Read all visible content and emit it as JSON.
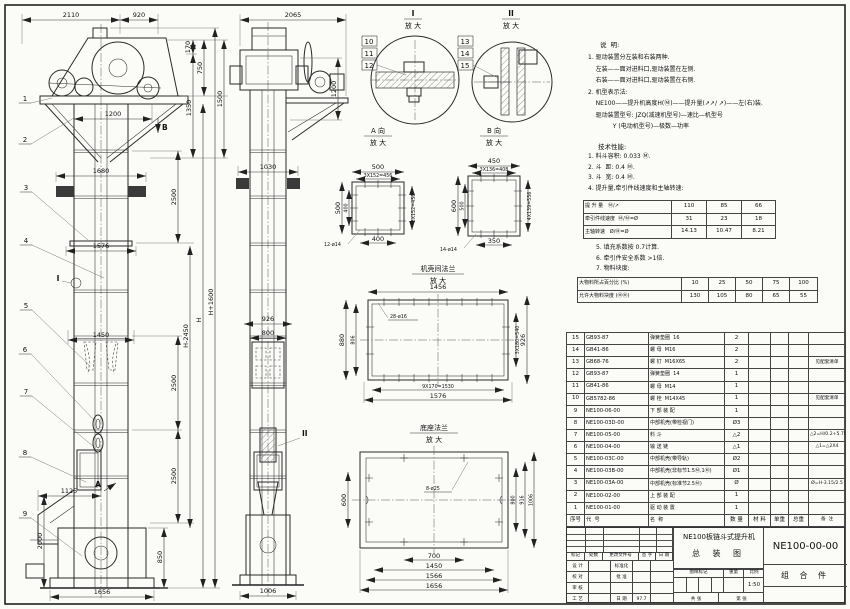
{
  "notes": {
    "title": "说  明:",
    "lines": [
      "1. 驱动装置分左装和右装两种.",
      "    左装——面对进料口,驱动装置在左侧.",
      "    右装——面对进料口,驱动装置在右侧.",
      "2. 机型表示法:",
      "    NE100——提升机高度H(Ⓜ)——提升量(↗↗/ ↗)——左(右)装.",
      "    驱动装置型号: JZQ(减速机型号)—速比—机型号",
      "             Y (电动机型号)—极数—功率"
    ]
  },
  "tech": {
    "title": "技术性能:",
    "lines": [
      "1. 料斗容积: 0.033 Ⓜ.",
      "2. 斗  距: 0.4 Ⓜ.",
      "3. 斗  宽: 0.4 Ⓜ.",
      "4. 提升量,牵引件线速度和主轴转速:"
    ],
    "lines2": [
      "5. 填充系数按 0.7计算.",
      "6. 牵引件安全系数 >1倍.",
      "7. 物料块度:"
    ]
  },
  "speed_table": {
    "rows": [
      [
        "提 升 量   Ⓜ/↗",
        "110",
        "85",
        "66"
      ],
      [
        "牵引件线速度  Ⓜ/Ⓜ=Ø",
        "31",
        "23",
        "18"
      ],
      [
        "主轴转速   Ø/Ⓜ=Ø",
        "14.13",
        "10.47",
        "8.21"
      ]
    ]
  },
  "lump_table": {
    "rows": [
      [
        "大物料所占百分比 (%)",
        "10",
        "25",
        "50",
        "75",
        "100"
      ],
      [
        "允许大物料块度 (ⓂⓂ)",
        "130",
        "105",
        "80",
        "65",
        "55"
      ]
    ]
  },
  "bom": {
    "rows": [
      {
        "seq": "15",
        "code": "GB93-87",
        "name": "弹簧垫圈  16",
        "qty": "2",
        "material": "",
        "uw": "",
        "tw": "",
        "remark": ""
      },
      {
        "seq": "14",
        "code": "GB41-86",
        "name": "螺 母  M16",
        "qty": "2",
        "material": "",
        "uw": "",
        "tw": "",
        "remark": ""
      },
      {
        "seq": "13",
        "code": "GB68-76",
        "name": "螺 钉  M16X65",
        "qty": "2",
        "material": "",
        "uw": "",
        "tw": "",
        "remark": "见配套清单"
      },
      {
        "seq": "12",
        "code": "GB93-87",
        "name": "弹簧垫圈  14",
        "qty": "1",
        "material": "",
        "uw": "",
        "tw": "",
        "remark": ""
      },
      {
        "seq": "11",
        "code": "GB41-86",
        "name": "螺 母  M14",
        "qty": "1",
        "material": "",
        "uw": "",
        "tw": "",
        "remark": ""
      },
      {
        "seq": "10",
        "code": "GB5782-86",
        "name": "螺 栓  M14X45",
        "qty": "1",
        "material": "",
        "uw": "",
        "tw": "",
        "remark": "见配套清单"
      },
      {
        "seq": "9",
        "code": "NE100-06-00",
        "name": "下 部 装 配",
        "qty": "1",
        "material": "",
        "uw": "",
        "tw": "",
        "remark": ""
      },
      {
        "seq": "8",
        "code": "NE100-03D-00",
        "name": "中部机壳(带检视门)",
        "qty": "Ø3",
        "material": "",
        "uw": "",
        "tw": "",
        "remark": ""
      },
      {
        "seq": "7",
        "code": "NE100-05-00",
        "name": "料 斗",
        "qty": "△2",
        "material": "",
        "uw": "",
        "tw": "",
        "remark": "△2=H/0.2+5.75"
      },
      {
        "seq": "6",
        "code": "NE100-04-00",
        "name": "输 送 链",
        "qty": "△1",
        "material": "",
        "uw": "",
        "tw": "",
        "remark": "△1=△2X4"
      },
      {
        "seq": "5",
        "code": "NE100-03C-00",
        "name": "中部机壳(带导轨)",
        "qty": "Ø2",
        "material": "",
        "uw": "",
        "tw": "",
        "remark": ""
      },
      {
        "seq": "4",
        "code": "NE100-03B-00",
        "name": "中部机壳(非标节1.5Ⓜ,1Ⓜ)",
        "qty": "Ø1",
        "material": "",
        "uw": "",
        "tw": "",
        "remark": ""
      },
      {
        "seq": "3",
        "code": "NE100-03A-00",
        "name": "中部机壳(标准节2.5Ⓜ)",
        "qty": "Ø",
        "material": "",
        "uw": "",
        "tw": "",
        "remark": "Ø=H-3.15/2.5"
      },
      {
        "seq": "2",
        "code": "NE100-02-00",
        "name": "上 部 装 配",
        "qty": "1",
        "material": "",
        "uw": "",
        "tw": "",
        "remark": ""
      },
      {
        "seq": "1",
        "code": "NE100-01-00",
        "name": "驱 动 装 置",
        "qty": "1",
        "material": "",
        "uw": "",
        "tw": "",
        "remark": ""
      }
    ],
    "footer": [
      "序号",
      "代  号",
      "名  称",
      "数 量",
      "材 料",
      "单重",
      "总重",
      "备  注"
    ]
  },
  "titleblock": {
    "rev_header": [
      "标记",
      "处数",
      "更改文件号",
      "签 字",
      "日 期"
    ],
    "r1a": "设 计",
    "r1b": "标准化",
    "r2a": "校 对",
    "r2b": "批 准",
    "r3a": "审 核",
    "r3b": "",
    "r4a": "工 艺",
    "r4b": "日 期",
    "r4c": "97.7",
    "stamp": [
      "图样标记",
      "重量",
      "比例"
    ],
    "scale": "1:50",
    "sheet_a": "共  张",
    "sheet_b": "第  张",
    "product": "NE100板链斗式提升机",
    "drawing_title": "总 装 图",
    "drawing_no": "NE100-00-00",
    "part_type": "组 合 件"
  },
  "balloons": [
    "1",
    "2",
    "3",
    "4",
    "5",
    "6",
    "7",
    "8",
    "9"
  ],
  "details": {
    "zoom": "放 大",
    "d1_label": "I",
    "d1": [
      "10",
      "11",
      "12"
    ],
    "d2_label": "II",
    "d2": [
      "13",
      "14",
      "15"
    ],
    "va_label": "A 向",
    "vb_label": "B 向",
    "flange_label": "机壳间法兰",
    "base_label": "底座法兰"
  },
  "dims": {
    "f_2110": "2110",
    "f_920": "920",
    "f_170": "170",
    "f_750": "750",
    "f_1350": "1350",
    "f_1500": "1500",
    "f_1200": "1200",
    "f_1680": "1680",
    "f_2500": "2500",
    "f_1576": "1576",
    "f_1450": "1450",
    "f_hm2450": "H-2450",
    "f_h": "H",
    "f_hp1600": "H+1600",
    "f_1125": "1125",
    "f_2000": "2000",
    "f_850": "850",
    "f_1656": "1656",
    "mk_a": "A",
    "mk_b": "B",
    "mk_i": "I",
    "mk_ii": "II",
    "s_2065": "2065",
    "s_1200": "1200",
    "s_1030": "1030",
    "s_926": "926",
    "s_800": "800",
    "s_1006": "1006",
    "a_500": "500",
    "a_456": "3X152=456",
    "a_400": "400",
    "a_holes": "12-ø14",
    "b_450": "450",
    "b_408": "3X136=408",
    "b_600": "600",
    "b_500": "500",
    "b_556": "4X139=556",
    "b_350": "350",
    "b_holes": "14-ø14",
    "fl_1456": "1456",
    "fl_holes": "28-ø16",
    "fl_880": "880",
    "fl_806": "806",
    "fl_540": "3X180=540",
    "fl_926": "926",
    "fl_1530": "9X170=1530",
    "fl_1576": "1576",
    "bs_holes": "8-ø25",
    "bs_600": "600",
    "bs_800": "800",
    "bs_916": "916",
    "bs_1006": "1006",
    "bs_700": "700",
    "bs_1450": "1450",
    "bs_1566": "1566",
    "bs_1656": "1656"
  }
}
